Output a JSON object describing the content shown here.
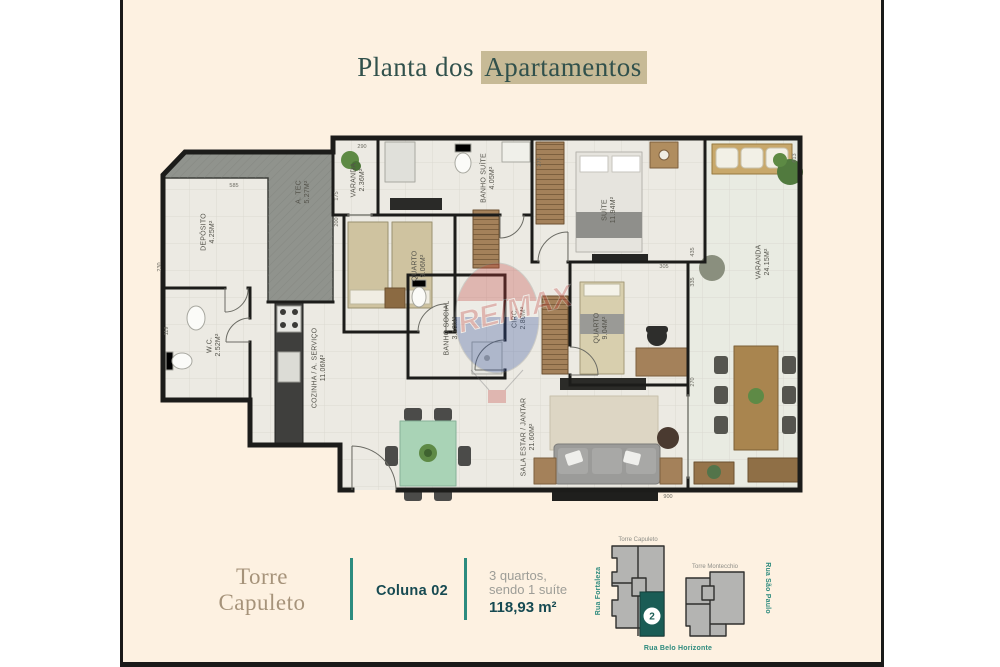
{
  "title": {
    "prefix": "Planta dos ",
    "highlight": "Apartamentos"
  },
  "plan": {
    "rooms": [
      {
        "name": "A. TEC",
        "area": "5.27M²"
      },
      {
        "name": "DEPÓSITO",
        "area": "4.25M²"
      },
      {
        "name": "W.C.",
        "area": "2.52M²"
      },
      {
        "name": "COZINHA / A. SERVIÇO",
        "area": "11.06M²"
      },
      {
        "name": "VARANDA",
        "area": "2.36M²"
      },
      {
        "name": "QUARTO",
        "area": "9.06M²"
      },
      {
        "name": "BANHO SUÍTE",
        "area": "4.05M²"
      },
      {
        "name": "BANHO SOCIAL",
        "area": "3.10M²"
      },
      {
        "name": "CIRC.",
        "area": "2.80M²"
      },
      {
        "name": "SUÍTE",
        "area": "11.94M²"
      },
      {
        "name": "QUARTO",
        "area": "9.04M²"
      },
      {
        "name": "SALA ESTAR / JANTAR",
        "area": "21.60M²"
      },
      {
        "name": "VARANDA",
        "area": "24.15M²"
      }
    ],
    "dimensions": [
      "290",
      "585",
      "175",
      "200",
      "230",
      "119",
      "275",
      "613",
      "435",
      "335",
      "305",
      "270",
      "900"
    ]
  },
  "watermark": {
    "brand": "RE/MAX"
  },
  "footer": {
    "tower": "Torre Capuleto",
    "column": "Coluna 02",
    "desc_line1": "3 quartos,",
    "desc_line2": "sendo 1 suíte",
    "area": "118,93 m²"
  },
  "keyplan": {
    "tower_left": "Torre Capuleto",
    "tower_right": "Torre Montecchio",
    "street_left": "Rua Fortaleza",
    "street_right": "Rua São Paulo",
    "street_bottom": "Rua Belo Horizonte",
    "unit_number": "2"
  },
  "colors": {
    "card_bg": "#fdf1e1",
    "accent_teal": "#2c8b7e",
    "dark_teal": "#164a52",
    "highlight_tan": "#c7ba96",
    "unit_fill": "#1a5c55",
    "wall": "#1c1c1a"
  }
}
